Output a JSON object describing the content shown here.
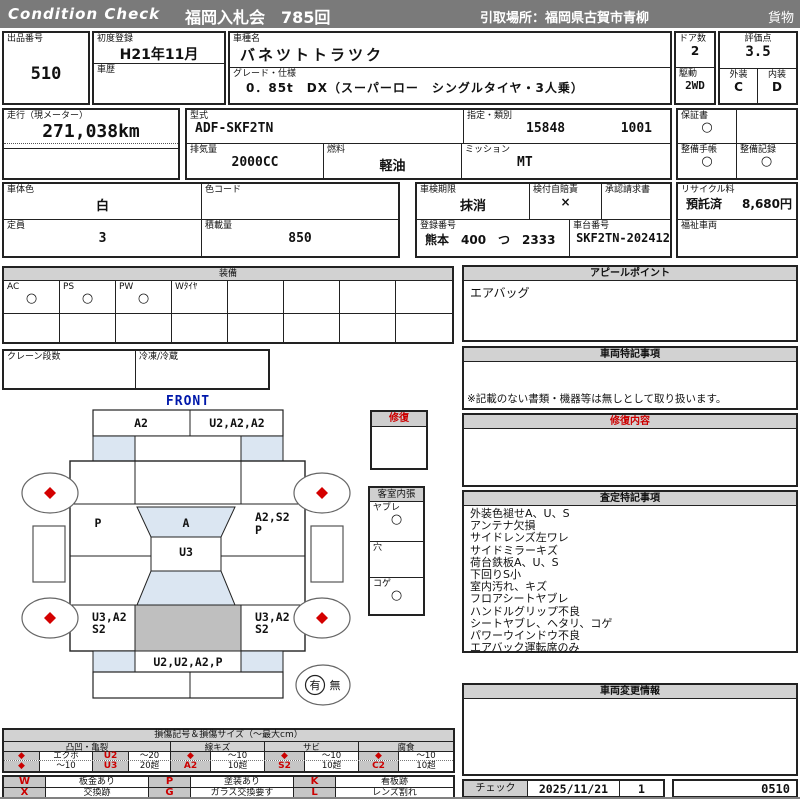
{
  "colors": {
    "accent_red": "#cc0000",
    "bar_gray": "#7a7a7a",
    "panel_gray": "#d2d2d2",
    "diagram_blue": "#dbe6f2",
    "bed_gray": "#bfbfbf",
    "label_blue": "#0018aa"
  },
  "header": {
    "brand": "Condition  Check",
    "auction": "福岡入札会　785回",
    "pickup": "引取場所：福岡県古賀市青柳",
    "category": "貨物"
  },
  "info": {
    "lot_label": "出品番号",
    "lot_no": "510",
    "first_reg_label": "初度登録",
    "first_reg": "H21年11月",
    "history_label": "車歴",
    "model_label": "車種名",
    "model": "バネツトトラツク",
    "grade_label": "グレード・仕様",
    "grade": "0．85t　DX（スーパーロー　シングルタイヤ・3人乗）",
    "doors_label": "ドア数",
    "doors": "2",
    "drive_label": "駆動",
    "drive": "2WD",
    "score_label": "評価点",
    "score": "3.5",
    "exterior_label": "外装",
    "exterior": "C",
    "interior_label": "内装",
    "interior": "D",
    "mileage_label": "走行（現メーター）",
    "mileage": "271,038km",
    "model_code_label": "型式",
    "model_code": "ADF-SKF2TN",
    "type_label": "指定・類別",
    "type_no1": "15848",
    "type_no2": "1001",
    "displacement_label": "排気量",
    "displacement": "2000CC",
    "fuel_label": "燃料",
    "fuel": "軽油",
    "transmission_label": "ミッション",
    "transmission": "MT",
    "warranty_label": "保証書",
    "warranty_mark": "○",
    "maintenance_book_label": "整備手帳",
    "maintenance_book_mark": "○",
    "maintenance_record_label": "整備記録",
    "maintenance_record_mark": "○",
    "color_label": "車体色",
    "body_color": "白",
    "color_code_label": "色コード",
    "inspection_label": "車検期限",
    "inspection": "抹消",
    "insurance_label": "検付自賠責",
    "insurance": "×",
    "approval_label": "承認請求書",
    "recycle_label": "リサイクル料",
    "recycle_status": "預託済",
    "recycle_fee": "8,680円",
    "capacity_label": "定員",
    "capacity": "3",
    "load_label": "積載量",
    "load": "850",
    "plate_label": "登録番号",
    "plate": "熊本　400　つ　2333",
    "chassis_label": "車台番号",
    "chassis": "SKF2TN-202412",
    "welfare_label": "福祉車両"
  },
  "equipment": {
    "title": "装備",
    "cols": [
      {
        "label": "AC",
        "mark": "○"
      },
      {
        "label": "PS",
        "mark": "○"
      },
      {
        "label": "PW",
        "mark": "○"
      },
      {
        "label": "Wﾀｲﾔ",
        "mark": ""
      },
      {
        "label": "",
        "mark": ""
      },
      {
        "label": "",
        "mark": ""
      },
      {
        "label": "",
        "mark": ""
      },
      {
        "label": "",
        "mark": ""
      }
    ],
    "crane_label": "クレーン段数",
    "reefer_label": "冷凍/冷蔵"
  },
  "panels": {
    "appeal": {
      "title": "アピールポイント",
      "content": "エアバッグ"
    },
    "vehicle_notes": {
      "title": "車両特記事項",
      "note": "※記載のない書類・機器等は無しとして取り扱います。"
    },
    "repair_detail": {
      "title": "修復内容"
    },
    "assessment": {
      "title": "査定特記事項",
      "lines": [
        "外装色褪せA、U、S",
        "アンテナ欠損",
        "サイドレンズ左ワレ",
        "サイドミラーキズ",
        "荷台鉄板A、U、S",
        "下回りS小",
        "室内汚れ、キズ",
        "フロアシートヤブレ",
        "ハンドルグリップ不良",
        "シートヤブレ、ヘタリ、コゲ",
        "パワーウインドウ不良",
        "エアバック運転席のみ"
      ]
    },
    "change_info": {
      "title": "車両変更情報"
    }
  },
  "check": {
    "label": "チェック",
    "date": "2025/11/21",
    "count": "1",
    "code": "0510"
  },
  "diagram": {
    "front": "FRONT",
    "rear": "REAR",
    "front_bumper_l": "A2",
    "front_bumper_r": "U2,A2,A2",
    "left_panel": "P",
    "windshield": "A",
    "cab_roof": "U3",
    "right_panel_1": "A2,S2",
    "right_panel_2": "P",
    "rear_left_1": "U3,A2",
    "rear_left_2": "S2",
    "rear_right_1": "U3,A2",
    "rear_right_2": "S2",
    "rear_bumper": "U2,U2,A2,P",
    "repair_title": "修復",
    "cabin_title": "客室内張",
    "cabin_items": [
      {
        "label": "ヤブレ",
        "mark": "○"
      },
      {
        "label": "穴",
        "mark": ""
      },
      {
        "label": "コゲ",
        "mark": "○"
      }
    ],
    "has": "有",
    "none": "無"
  },
  "legend": {
    "title": "損傷記号＆損傷サイズ（～最大cm）",
    "groups": [
      "凸凹・亀裂",
      "線キズ",
      "サビ",
      "腐食"
    ],
    "row1": [
      "◆",
      "エクボ",
      "U2",
      "～20",
      "◆",
      "～10",
      "◆",
      "～10",
      "◆",
      "～10"
    ],
    "row2": [
      "◆",
      "～10",
      "U3",
      "20超",
      "A2",
      "10超",
      "S2",
      "10超",
      "C2",
      "10超"
    ],
    "marks_row1": [
      "W",
      "板金あり",
      "P",
      "塗装あり",
      "K",
      "看板跡"
    ],
    "marks_row2": [
      "X",
      "交換跡",
      "G",
      "ガラス交換要す",
      "L",
      "レンズ割れ"
    ]
  }
}
